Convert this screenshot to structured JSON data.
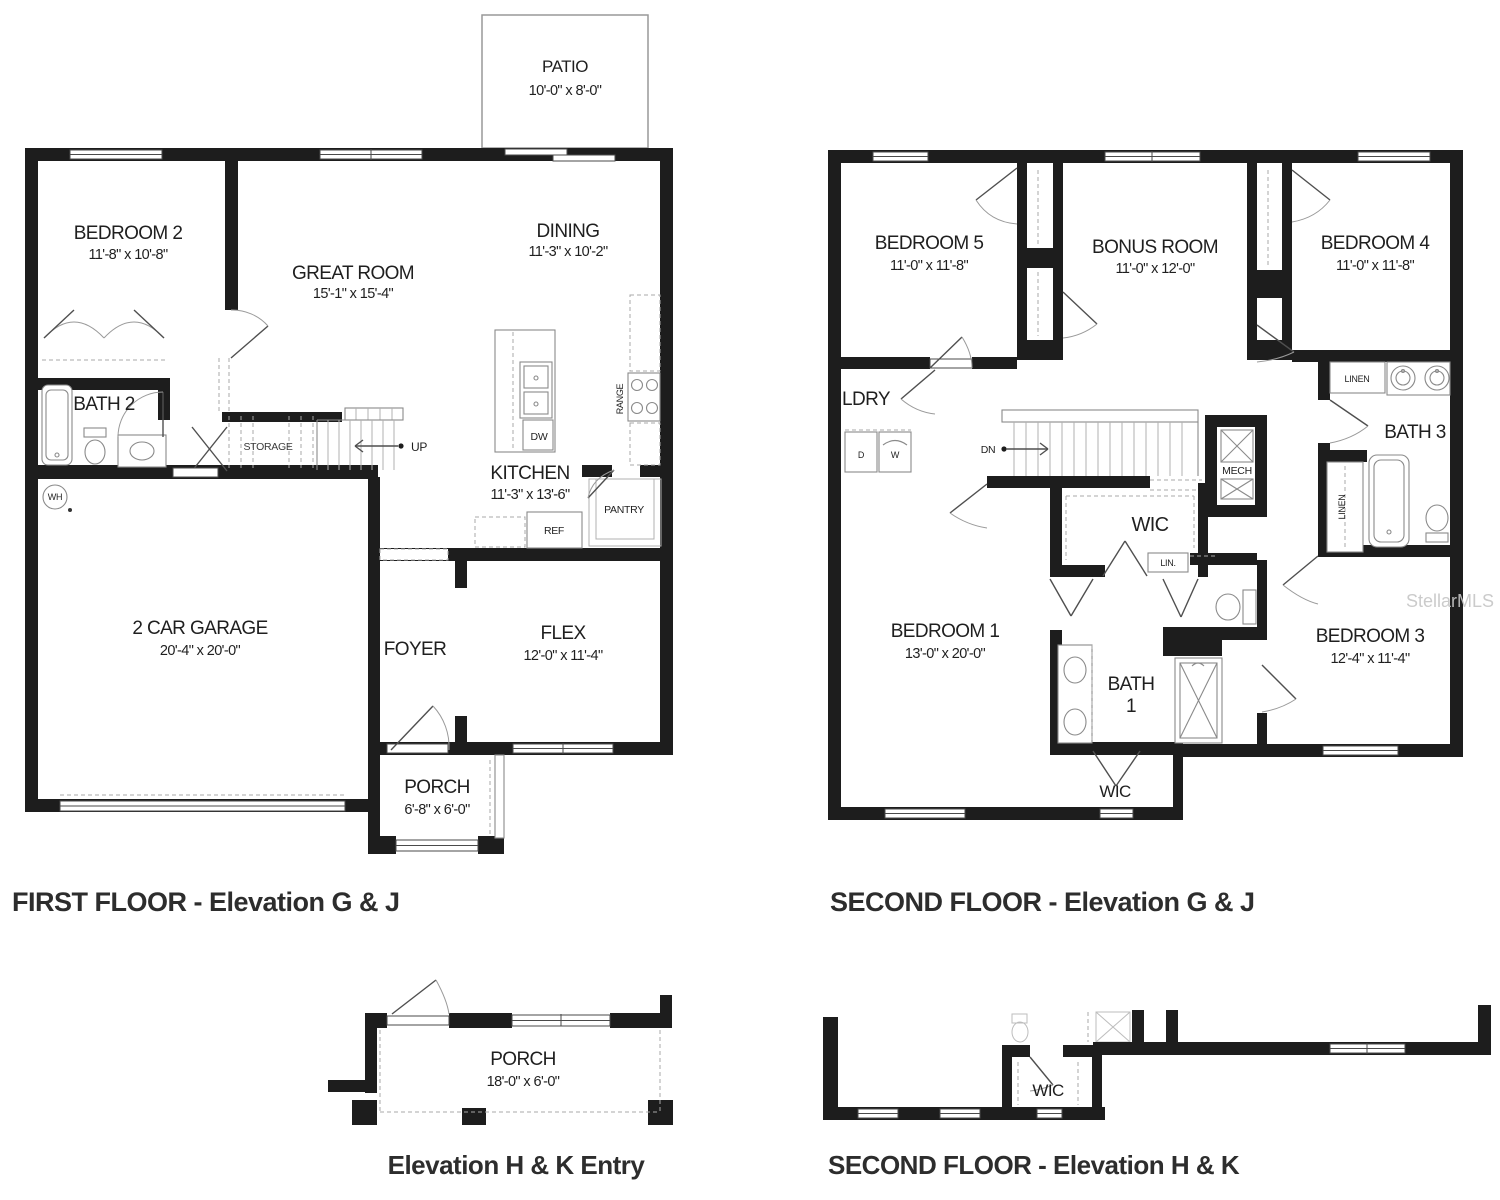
{
  "watermark": "StellarMLS",
  "first_floor": {
    "title": "FIRST FLOOR - Elevation G & J",
    "rooms": {
      "patio": {
        "name": "PATIO",
        "dims": "10'-0\" x 8'-0\""
      },
      "bedroom2": {
        "name": "BEDROOM 2",
        "dims": "11'-8\" x 10'-8\""
      },
      "great_room": {
        "name": "GREAT ROOM",
        "dims": "15'-1\" x 15'-4\""
      },
      "dining": {
        "name": "DINING",
        "dims": "11'-3\" x 10'-2\""
      },
      "bath2": {
        "name": "BATH 2"
      },
      "kitchen": {
        "name": "KITCHEN",
        "dims": "11'-3\" x 13'-6\""
      },
      "garage": {
        "name": "2 CAR GARAGE",
        "dims": "20'-4\" x 20'-0\""
      },
      "foyer": {
        "name": "FOYER"
      },
      "flex": {
        "name": "FLEX",
        "dims": "12'-0\" x 11'-4\""
      },
      "porch": {
        "name": "PORCH",
        "dims": "6'-8\" x 6'-0\""
      }
    },
    "labels": {
      "storage": "STORAGE",
      "up": "UP",
      "range": "RANGE",
      "dw": "DW",
      "ref": "REF",
      "pantry": "PANTRY",
      "wh": "WH"
    }
  },
  "second_floor": {
    "title": "SECOND FLOOR - Elevation G & J",
    "rooms": {
      "bedroom5": {
        "name": "BEDROOM 5",
        "dims": "11'-0\" x 11'-8\""
      },
      "bonus": {
        "name": "BONUS ROOM",
        "dims": "11'-0\" x 12'-0\""
      },
      "bedroom4": {
        "name": "BEDROOM 4",
        "dims": "11'-0\" x 11'-8\""
      },
      "ldry": {
        "name": "LDRY"
      },
      "bath3": {
        "name": "BATH 3"
      },
      "wic": {
        "name": "WIC"
      },
      "bedroom1": {
        "name": "BEDROOM 1",
        "dims": "13'-0\" x 20'-0\""
      },
      "bath1": {
        "line1": "BATH",
        "line2": "1"
      },
      "bedroom3": {
        "name": "BEDROOM 3",
        "dims": "12'-4\" x 11'-4\""
      },
      "wic2": {
        "name": "WIC"
      }
    },
    "labels": {
      "d": "D",
      "w": "W",
      "dn": "DN",
      "mech": "MECH",
      "linen": "LINEN",
      "linen2": "LINEN",
      "lin": "LIN."
    }
  },
  "entry_elevation": {
    "title": "Elevation H & K Entry",
    "porch": {
      "name": "PORCH",
      "dims": "18'-0\" x 6'-0\""
    }
  },
  "second_floor_hk": {
    "title": "SECOND FLOOR - Elevation H & K",
    "wic": "WIC"
  }
}
